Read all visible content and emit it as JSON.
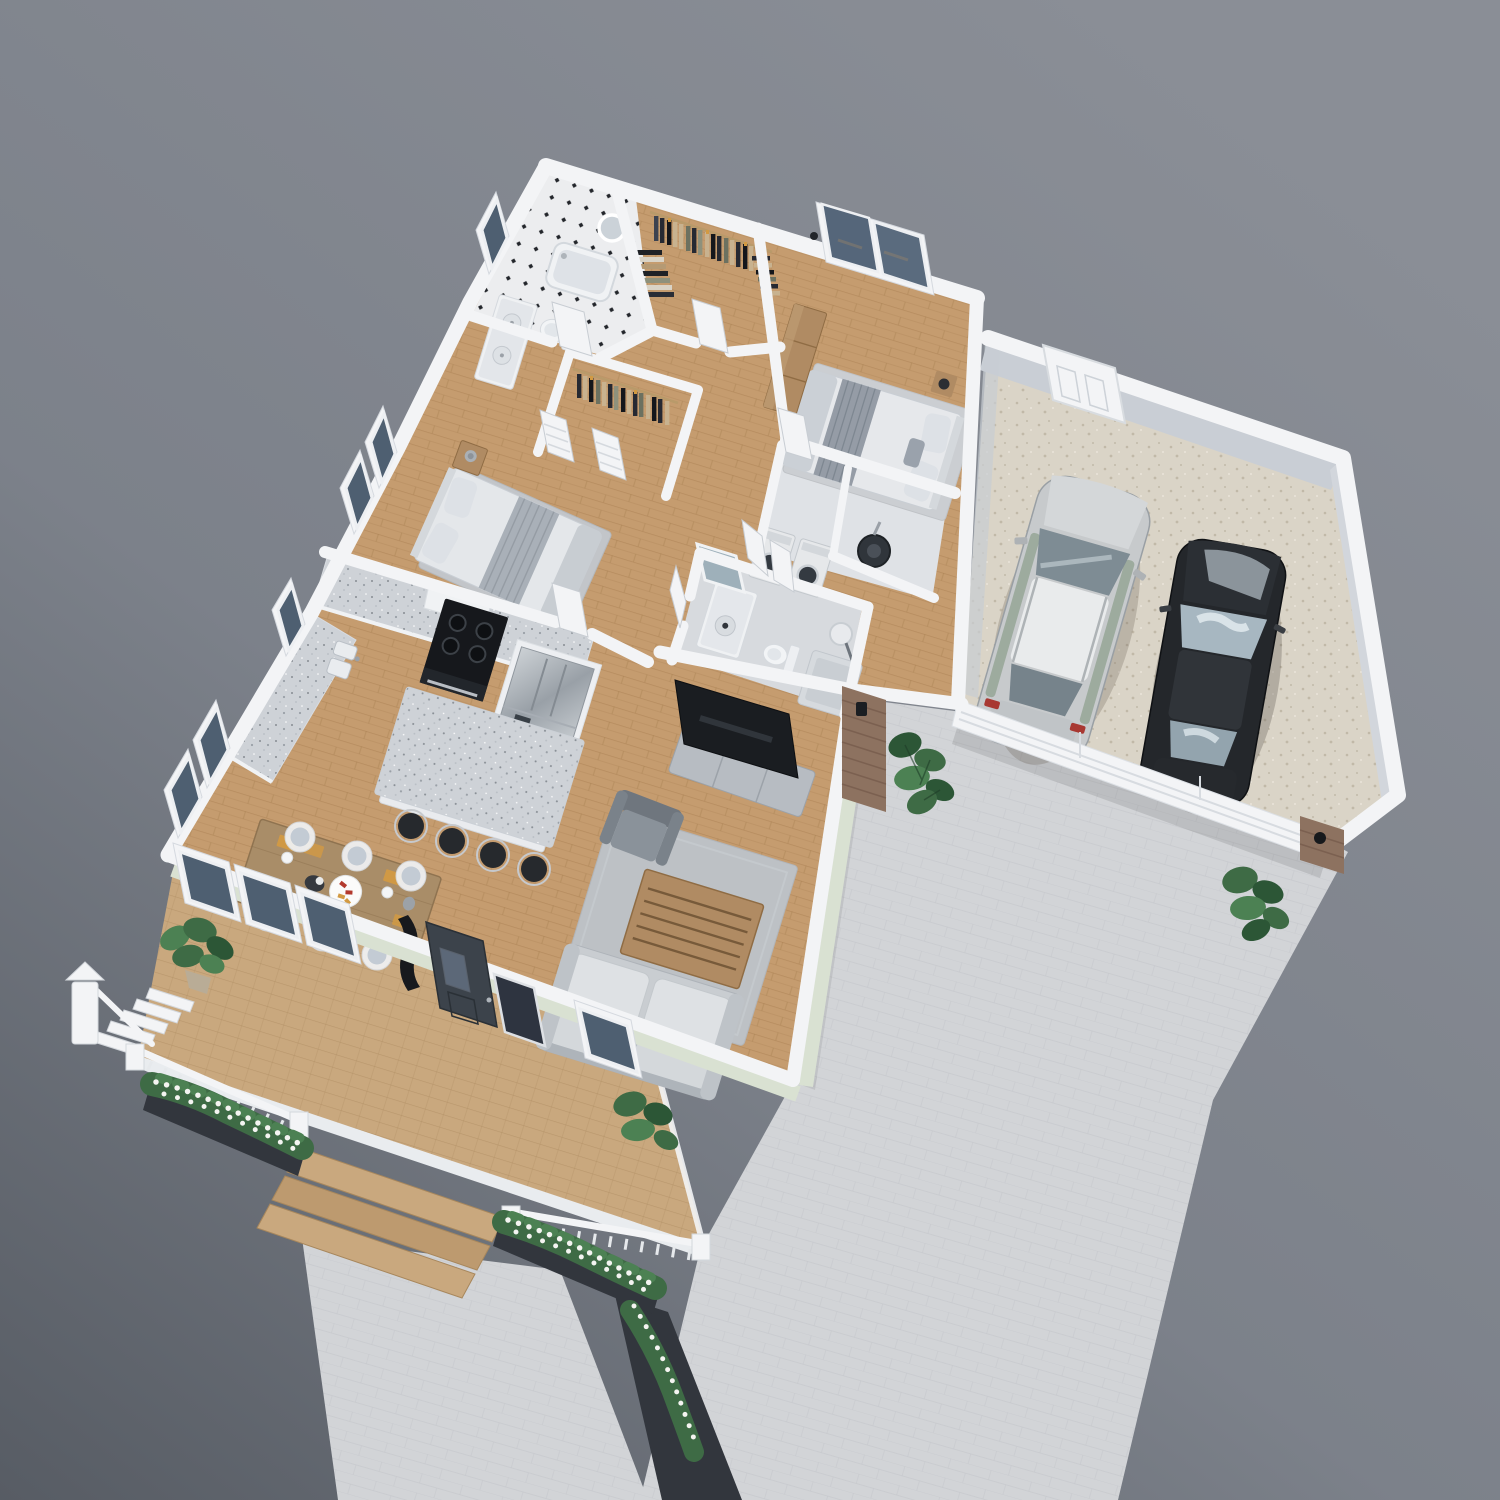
{
  "meta": {
    "title": "3D Dollhouse Floor Plan Rendering",
    "type": "isometric architectural visualization",
    "view": "cutaway top-down view of a single-story house with attached two-car garage"
  },
  "colors": {
    "bg1": "#8A8E96",
    "bg2": "#7C818A",
    "bg3": "#575C64",
    "drive1": "#D2D4D7",
    "drive2": "#C2C5CA",
    "planter": "#32363D",
    "deck1": "#C9A87E",
    "deck2": "#AE8C61",
    "wood1": "#C59C6F",
    "wood2": "#A87E50",
    "wall": "#F3F4F6",
    "wallshade": "#D8DCE2",
    "wallinner": "#C9CED5",
    "sage": "#D9E1D2",
    "garage1": "#DAD4C7",
    "garage2": "#C1B9A8",
    "glass": "#4E5F71",
    "glass2": "#7C8FA0",
    "rug": "#C2C5C9",
    "rug2": "#CBCED2",
    "sofa": "#C9CDD1",
    "sofa2": "#AEB4BA",
    "cushion": "#DEE1E4",
    "chair": "#7F868E",
    "woodfurn": "#B08B63",
    "woodfurn2": "#8F6C44",
    "tv": "#1A1D21",
    "console": "#B7BCC2",
    "granite1": "#CED2D7",
    "steel1": "#CCD1D5",
    "steel2": "#99A0A7",
    "door": "#3C434B",
    "silver": "#C7CACC",
    "carblack": "#24272B",
    "leaf": "#3E6B45",
    "leaf2": "#4C8153",
    "leafdk": "#2C5636",
    "flower": "#F4F4F1",
    "brick": "#8D7260",
    "brickdk": "#74594A",
    "tile": "#ECEDEF",
    "tile2": "#D7DADE",
    "cl0": "#262932",
    "cl1": "#C8B28F",
    "cl2": "#6C7160",
    "cl3": "#14161B",
    "cl4": "#8E917C",
    "cl5": "#3C4250",
    "accent": "#D29A43"
  },
  "scene": {
    "outdoor": {
      "driveway": "paver driveway in front of garage",
      "walkway": "paver walkway from front steps",
      "deck": {
        "floor": "herringbone wood deck",
        "features": [
          "white railing",
          "white newel posts",
          "side stairs",
          "front steps",
          "flower boxes with white blossoms",
          "potted plant"
        ]
      },
      "landscaping": [
        "monstera plant at entry nook",
        "monstera plant at garage corner",
        "flower beds along walkway"
      ]
    },
    "rooms": [
      {
        "name": "living-room",
        "floor": "herringbone wood",
        "furniture": [
          "light gray sofa",
          "wood slat coffee table",
          "gray armchair",
          "flat screen tv",
          "gray media console",
          "gray area rug"
        ]
      },
      {
        "name": "dining-area",
        "floor": "herringbone wood",
        "furniture": [
          "wood dining table",
          "six white chairs with gray cushions",
          "orange place mats",
          "white serving platter",
          "dark bowl"
        ]
      },
      {
        "name": "kitchen",
        "floor": "herringbone wood",
        "furniture": [
          "l-shaped granite counter",
          "white cabinets",
          "double sink",
          "black range",
          "range hood",
          "stainless refrigerator",
          "granite island",
          "four black bar stools"
        ]
      },
      {
        "name": "bedroom-2",
        "floor": "herringbone wood",
        "furniture": [
          "double bed",
          "wood nightstand",
          "lamp",
          "gray rug"
        ]
      },
      {
        "name": "bathroom-1",
        "floor": "black and white mosaic tile",
        "furniture": [
          "bathtub",
          "toilet",
          "double sink vanity",
          "round mirror"
        ]
      },
      {
        "name": "walk-in-closet-1",
        "contents": [
          "hanging clothes on rods",
          "folded sweaters"
        ]
      },
      {
        "name": "walk-in-closet-2",
        "contents": [
          "hanging clothes on rod",
          "louvered doors"
        ]
      },
      {
        "name": "master-bedroom",
        "floor": "wood with gray rug",
        "furniture": [
          "double bed with striped runner",
          "wood dresser bench",
          "nightstand with lamp",
          "sliding glass patio door"
        ]
      },
      {
        "name": "laundry-room",
        "furniture": [
          "washer",
          "dryer",
          "water heater",
          "bifold doors"
        ]
      },
      {
        "name": "bathroom-2",
        "floor": "gray tile",
        "furniture": [
          "vanity with round sink",
          "mirror",
          "toilet",
          "shower with glass panel"
        ]
      },
      {
        "name": "garage",
        "floor": "speckled concrete",
        "contents": [
          "silver suv",
          "black sedan",
          "white service door",
          "white garage door"
        ]
      }
    ]
  }
}
